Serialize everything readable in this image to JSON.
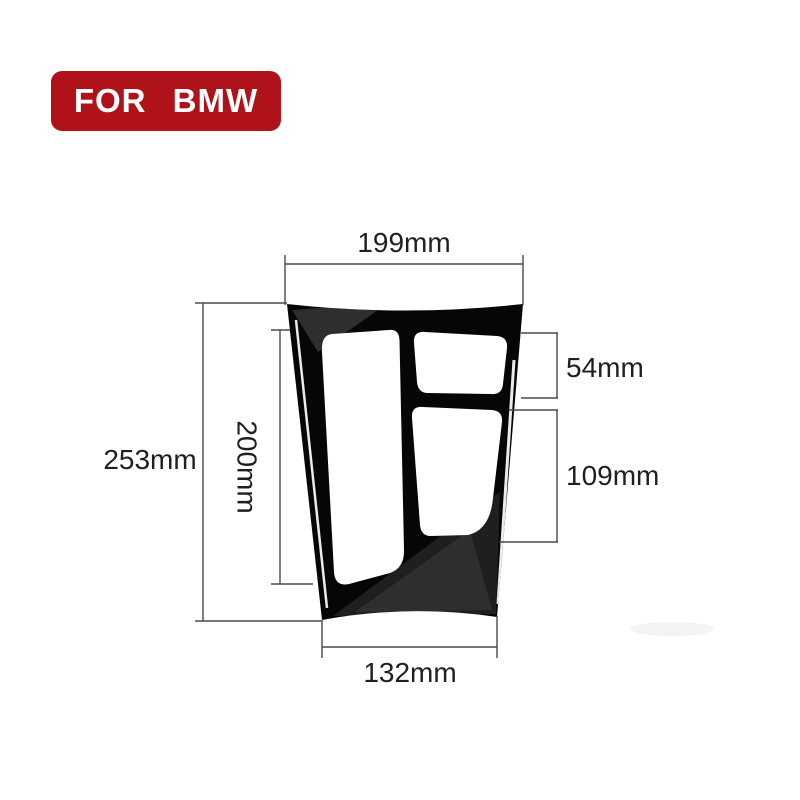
{
  "page": {
    "background_color": "#ffffff"
  },
  "badge": {
    "label": "FOR BMW",
    "background_color": "#b0121a",
    "text_color": "#ffffff"
  },
  "diagram": {
    "subject": "gear-shift-console-panel-trim",
    "panel_color": "#060606",
    "cutout_color": "#ffffff",
    "dimension_line_color": "#4a4a4a",
    "label_color": "#1f1f1f",
    "labels": {
      "top_width": "199mm",
      "overall_height": "253mm",
      "inner_height": "200mm",
      "upper_right_cutout": "54mm",
      "lower_right_cutout": "109mm",
      "bottom_width": "132mm"
    }
  }
}
